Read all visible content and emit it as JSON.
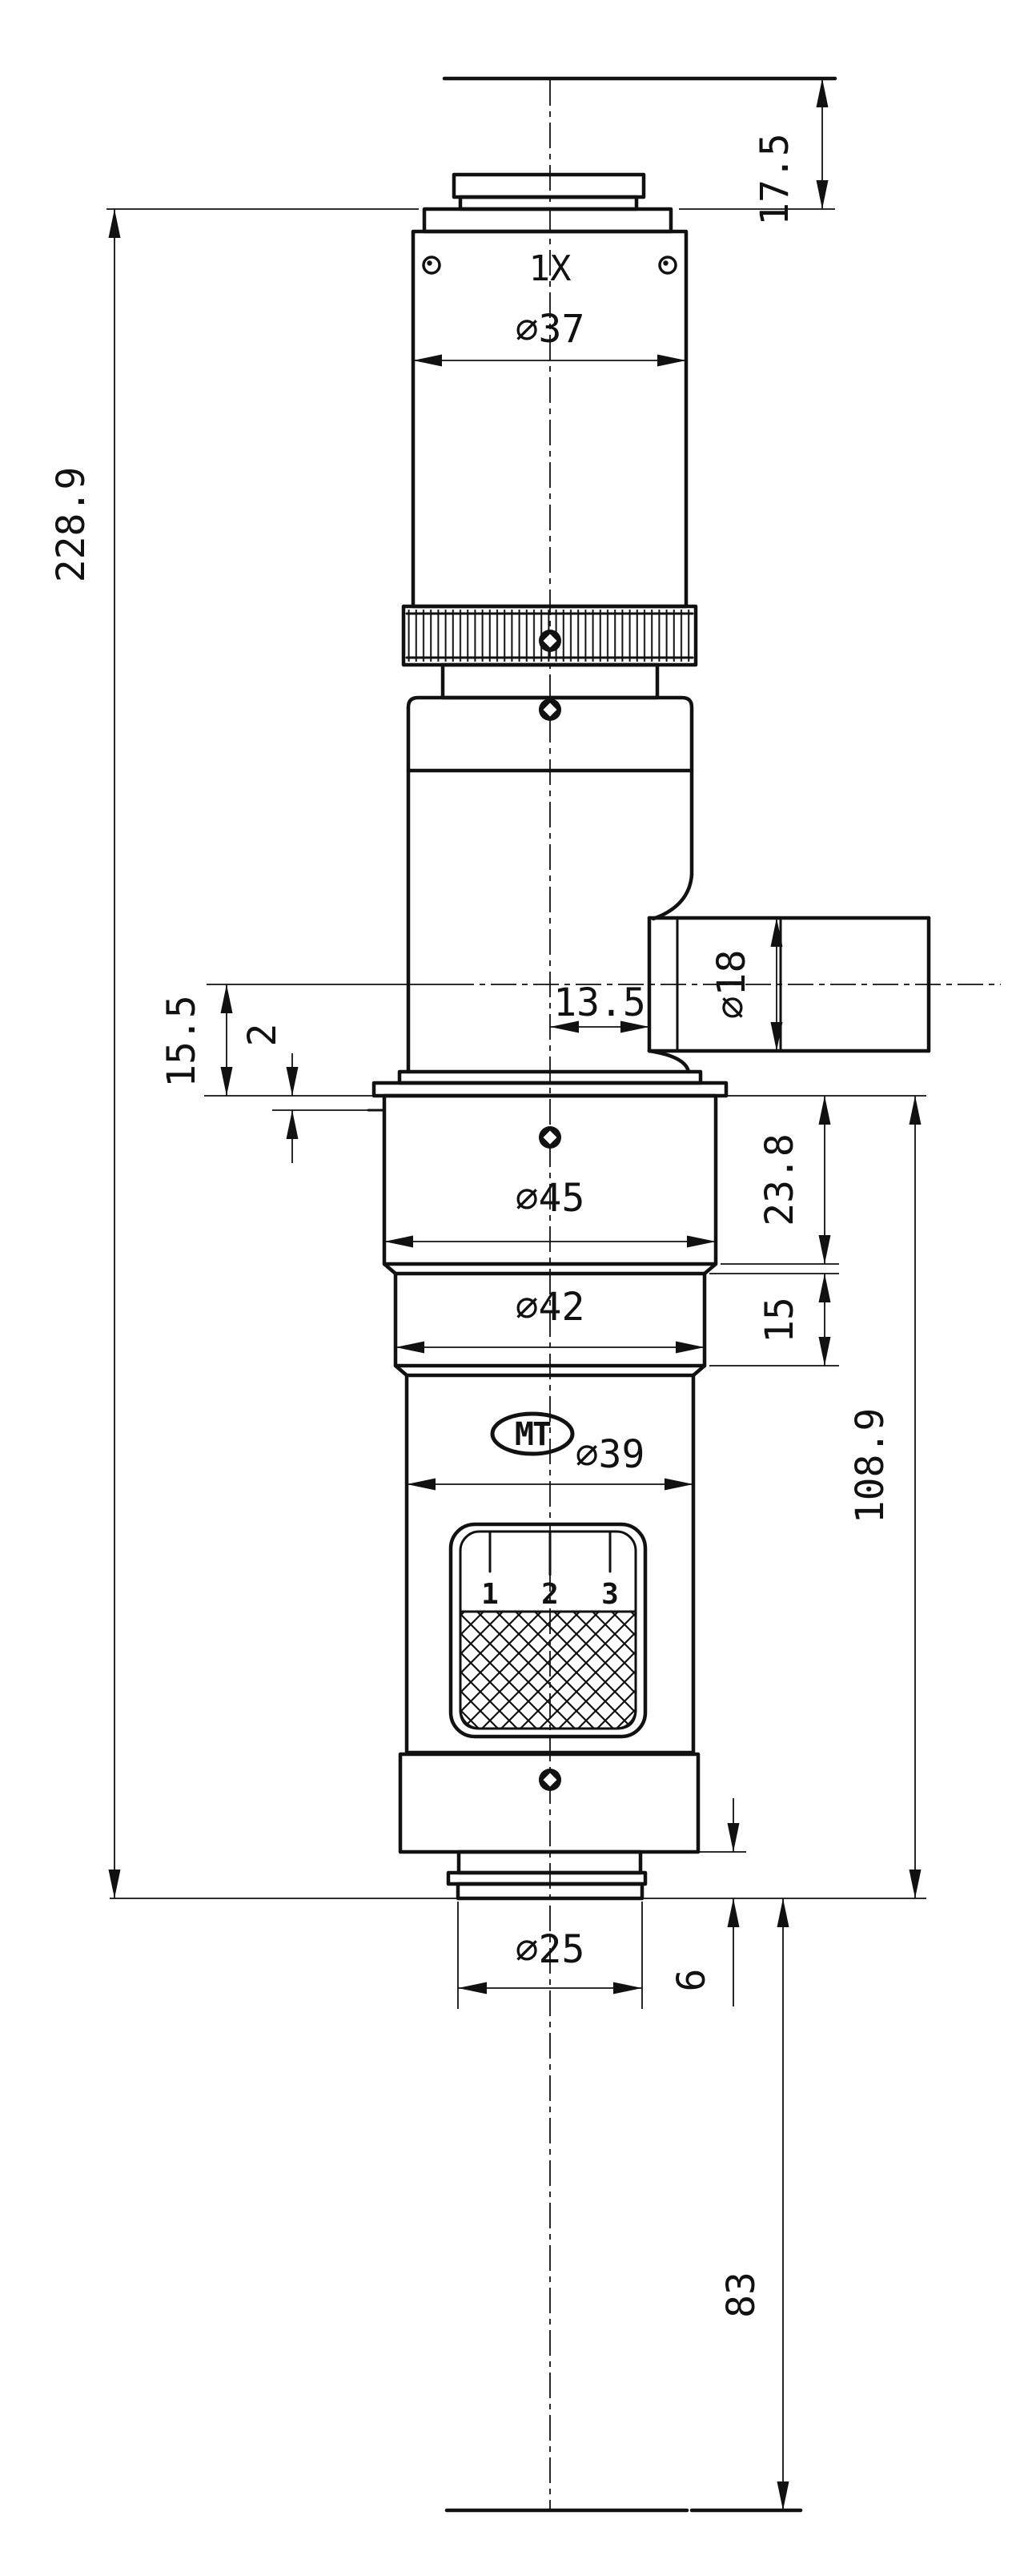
{
  "drawing": {
    "magnification": "1X",
    "logo": "MT",
    "zoom_marks": [
      "1",
      "2",
      "3"
    ],
    "dims": {
      "flange_focal_distance": "17.5",
      "tube_diameter": "∅37",
      "overall_length": "228.9",
      "port_offset": "13.5",
      "port_diameter": "∅18",
      "axis_to_flange": "15.5",
      "flange_step": "2",
      "flange_section_diameter": "∅45",
      "flange_section_length": "23.8",
      "ring_section_diameter": "∅42",
      "ring_section_length": "15",
      "body_diameter": "∅39",
      "lower_assembly_length": "108.9",
      "objective_diameter": "∅25",
      "nose_length": "6",
      "working_distance": "83"
    },
    "colors": {
      "ink": "#111111",
      "paper": "#ffffff"
    }
  }
}
